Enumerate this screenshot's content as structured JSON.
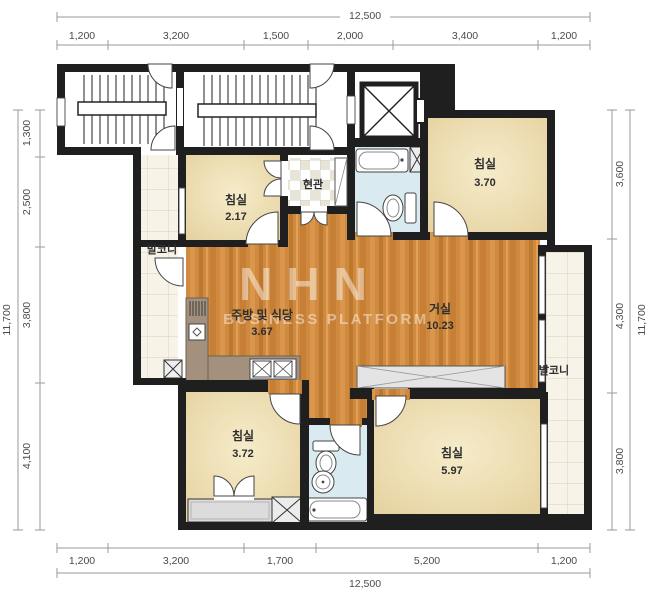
{
  "watermark": {
    "brand": "NHN",
    "subtitle": "BUSINESS PLATFORM"
  },
  "dimensions": {
    "top": {
      "total": "12,500",
      "segments": [
        "1,200",
        "3,200",
        "1,500",
        "2,000",
        "3,400",
        "1,200"
      ]
    },
    "bottom": {
      "total": "12,500",
      "segments": [
        "1,200",
        "3,200",
        "1,700",
        "5,200",
        "1,200"
      ]
    },
    "left": {
      "total": "11,700",
      "segments": [
        "1,300",
        "2,500",
        "3,800",
        "4,100"
      ]
    },
    "right": {
      "total": "11,700",
      "segments": [
        "3,600",
        "4,300",
        "3,800"
      ]
    }
  },
  "rooms": {
    "bedroom_top_left": {
      "label": "침실",
      "area": "2.17"
    },
    "bedroom_top_right": {
      "label": "침실",
      "area": "3.70"
    },
    "entrance": {
      "label": "현관"
    },
    "balcony_left": {
      "label": "발코니"
    },
    "kitchen_dining": {
      "label": "주방 및 식당",
      "area": "3.67"
    },
    "living_room": {
      "label": "거실",
      "area": "10.23"
    },
    "balcony_right": {
      "label": "발코니"
    },
    "bedroom_bottom_left": {
      "label": "침실",
      "area": "3.72"
    },
    "bedroom_bottom_right": {
      "label": "침실",
      "area": "5.97"
    }
  },
  "colors": {
    "wall": "#1f1f1f",
    "wood_floor": "#cf8a3f",
    "bedroom_floor": "#eddfb6",
    "bathroom_floor": "#d9eaf0",
    "balcony_tile": "#f7f3e8",
    "counter": "#a3917d",
    "dimension_line": "#9a9a9a"
  }
}
